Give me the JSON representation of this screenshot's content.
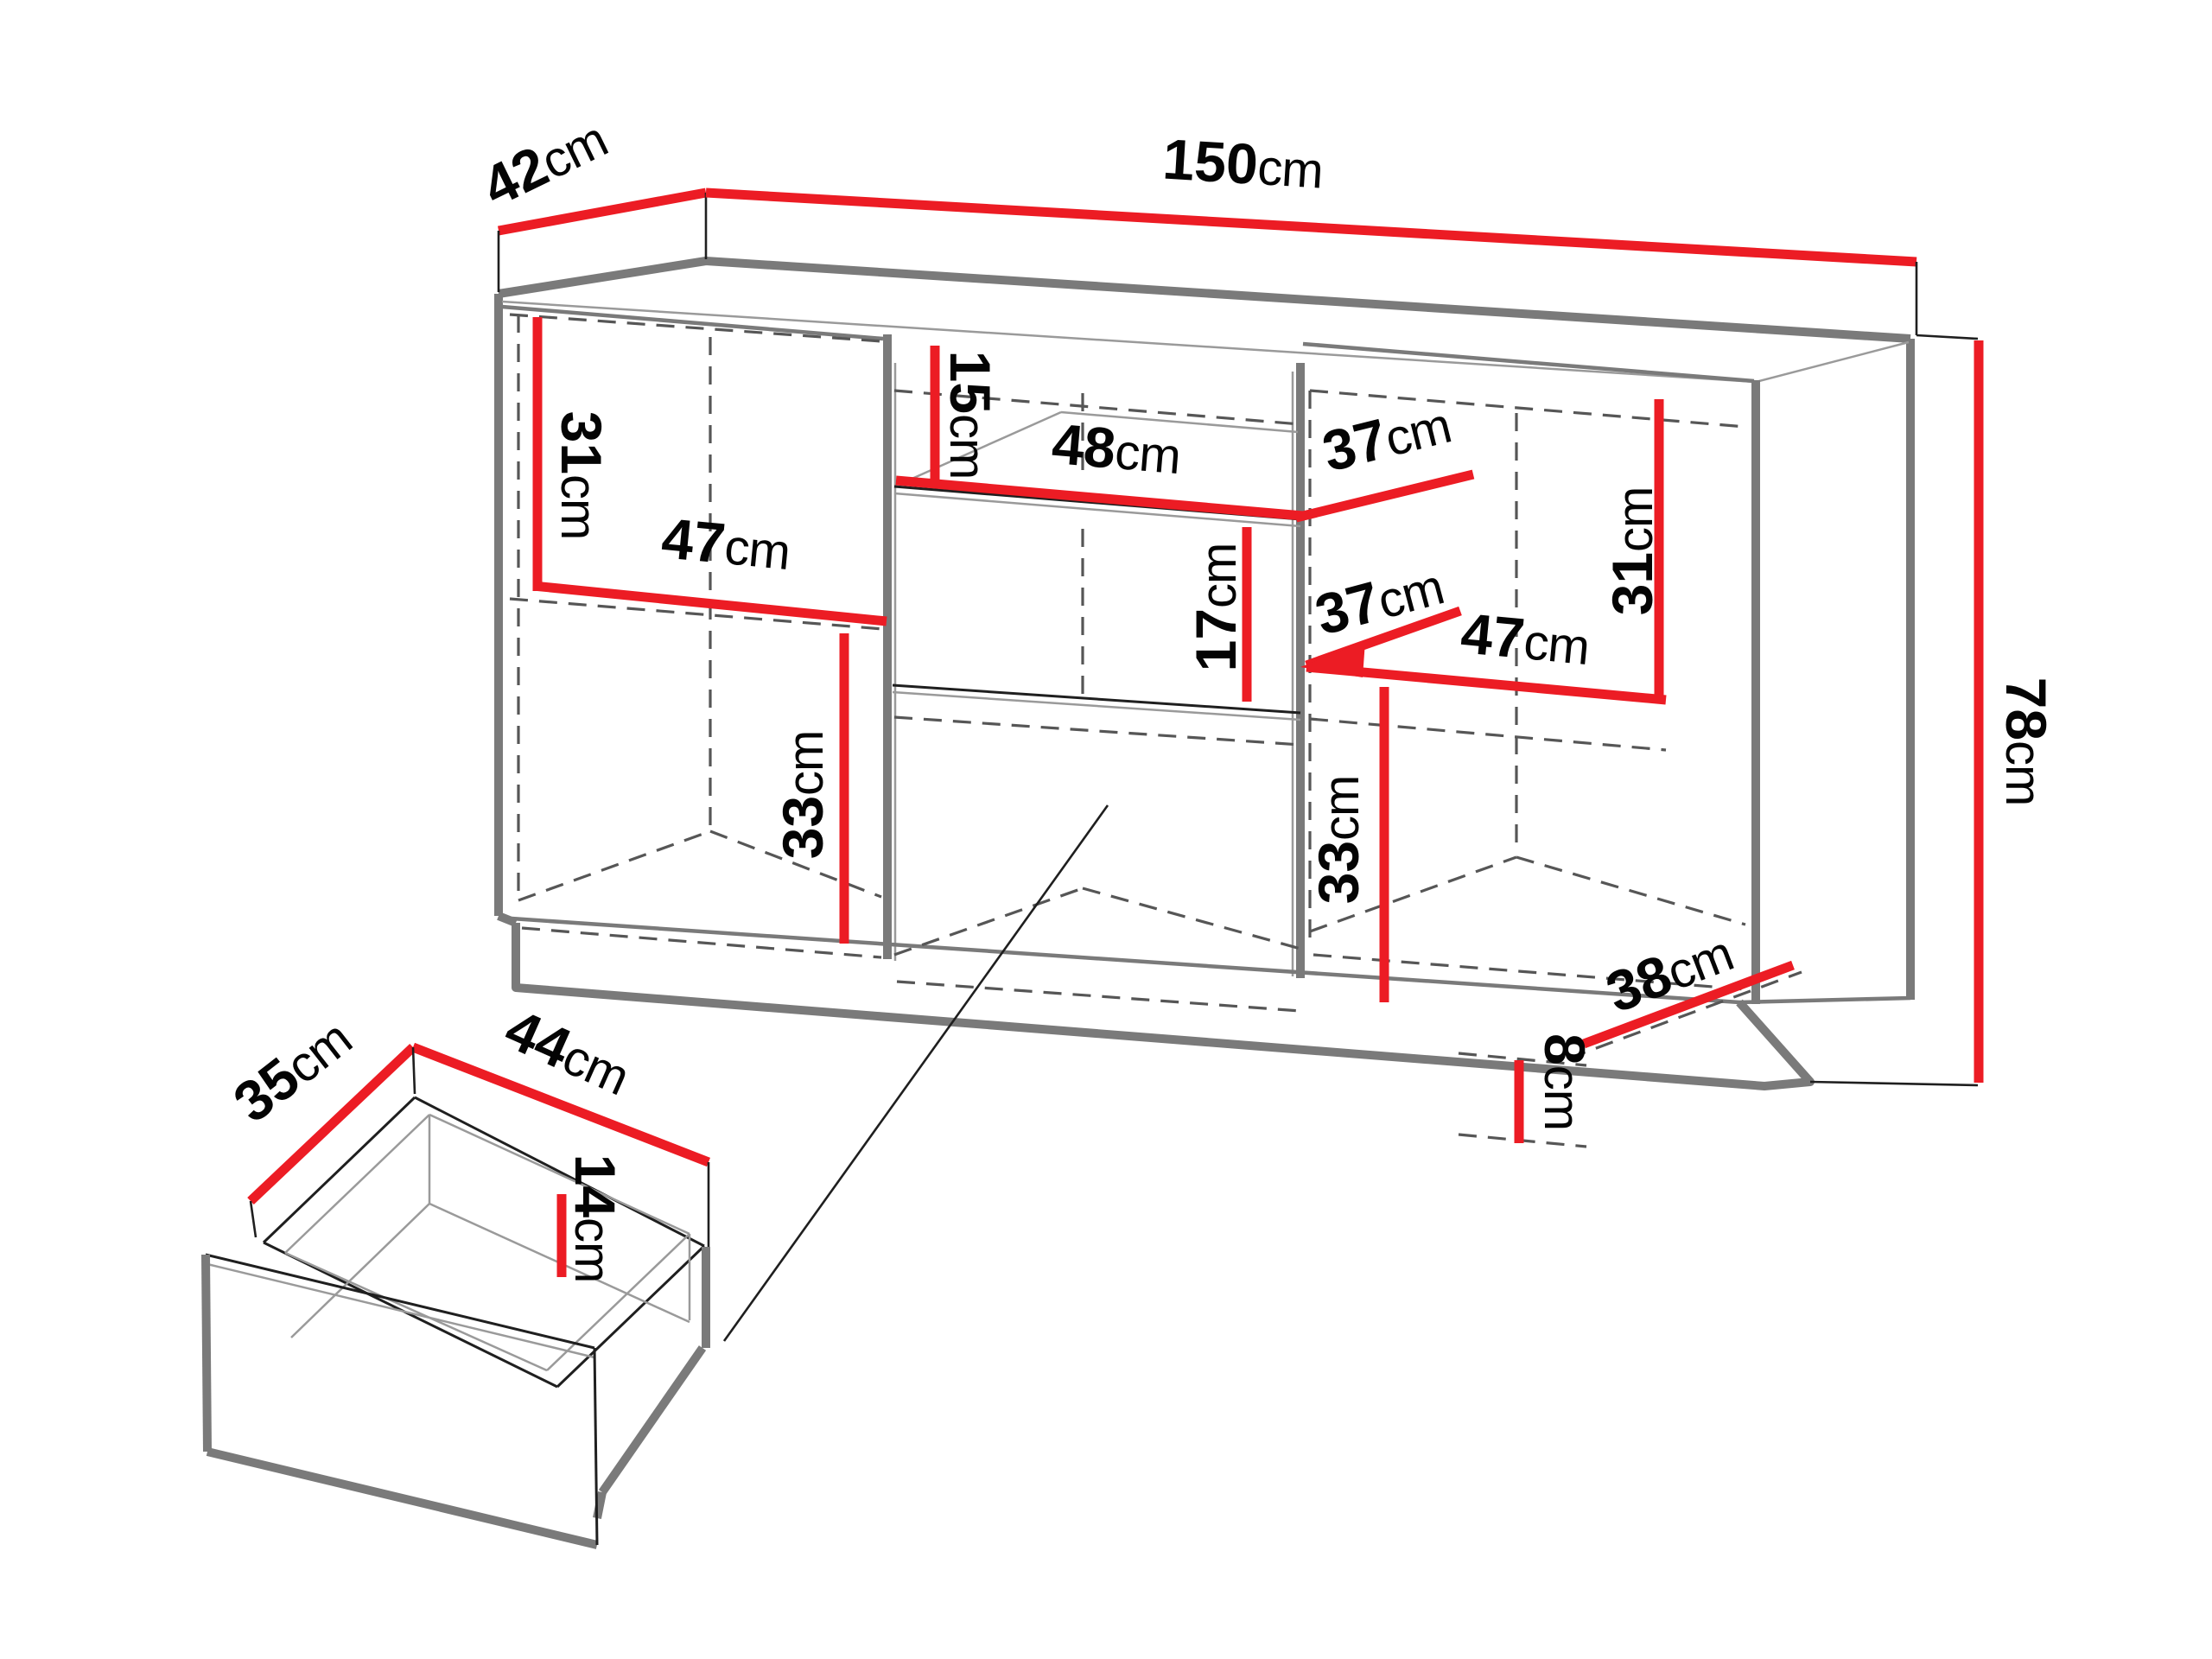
{
  "figure": {
    "kind": "furniture-dimension-diagram",
    "views": [
      "sideboard-cabinet",
      "detached-drawer"
    ],
    "unit": "cm"
  },
  "colors": {
    "red": "#ec1c24",
    "gray": "#7a7a7a",
    "midgray": "#9a9a9a",
    "dash": "#565656",
    "dark": "#1f1f1f",
    "text": "#040404",
    "bg": "#ffffff"
  },
  "dims": {
    "d42": {
      "v": "42",
      "u": "cm"
    },
    "d150": {
      "v": "150",
      "u": "cm"
    },
    "d31L": {
      "v": "31",
      "u": "cm"
    },
    "d47L": {
      "v": "47",
      "u": "cm"
    },
    "d15": {
      "v": "15",
      "u": "cm"
    },
    "d48": {
      "v": "48",
      "u": "cm"
    },
    "d37A": {
      "v": "37",
      "u": "cm"
    },
    "d17": {
      "v": "17",
      "u": "cm"
    },
    "d37B": {
      "v": "37",
      "u": "cm"
    },
    "d47R": {
      "v": "47",
      "u": "cm"
    },
    "d31R": {
      "v": "31",
      "u": "cm"
    },
    "d33L": {
      "v": "33",
      "u": "cm"
    },
    "d33R": {
      "v": "33",
      "u": "cm"
    },
    "d78": {
      "v": "78",
      "u": "cm"
    },
    "d38": {
      "v": "38",
      "u": "cm"
    },
    "d8": {
      "v": "8",
      "u": "cm"
    },
    "d35": {
      "v": "35",
      "u": "cm"
    },
    "d44": {
      "v": "44",
      "u": "cm"
    },
    "d14": {
      "v": "14",
      "u": "cm"
    }
  }
}
